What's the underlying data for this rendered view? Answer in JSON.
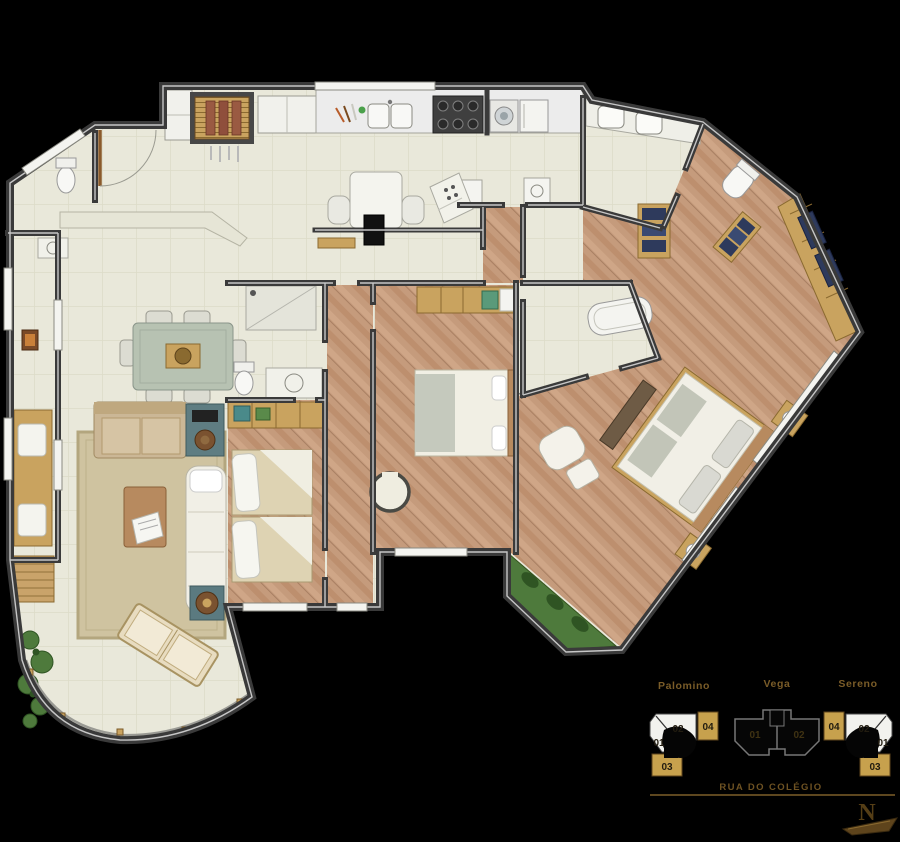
{
  "keyplan": {
    "buildings": [
      {
        "name": "Palomino",
        "units": [
          {
            "label": "02"
          },
          {
            "label": "04"
          },
          {
            "label": "01"
          },
          {
            "label": "03"
          }
        ],
        "highlighted_units": [
          "03",
          "04"
        ]
      },
      {
        "name": "Vega",
        "units": [
          {
            "label": "01"
          },
          {
            "label": "02"
          }
        ],
        "highlighted_units": []
      },
      {
        "name": "Sereno",
        "units": [
          {
            "label": "04"
          },
          {
            "label": "02"
          },
          {
            "label": "01"
          },
          {
            "label": "03"
          }
        ],
        "highlighted_units": [
          "03",
          "04"
        ]
      }
    ],
    "street_label": "RUA DO COLÉGIO"
  },
  "compass": {
    "north_label": "N"
  },
  "colors": {
    "background": "#000000",
    "walls": "#3a3a3a",
    "tile_floor": "#e9e8da",
    "wood_floor": "#c59b7c",
    "gold_highlight": "#c7a14d",
    "label_text": "#7a5c28",
    "plants": "#4e7a3c",
    "rug": "#cfc3a0"
  }
}
